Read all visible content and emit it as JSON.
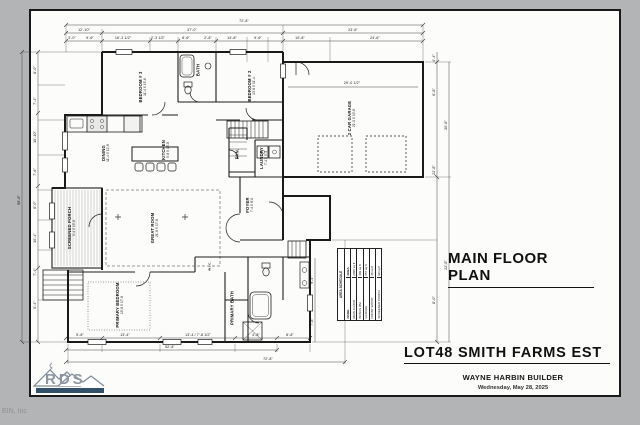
{
  "titleblock": {
    "plan_title": "MAIN FLOOR PLAN",
    "lot_title": "LOT48 SMITH FARMS EST",
    "builder": "WAYNE HARBIN BUILDER",
    "date": "Wednesday, May 28, 2025"
  },
  "logo": {
    "text": "RDS"
  },
  "footer": {
    "stamp": "EIN, Inc"
  },
  "colors": {
    "line": "#1a1a1a",
    "paper": "#fcfcfb",
    "page_background": "#b2b4b6",
    "logo_gray": "#8d97a3",
    "logo_bar_blue": "#33506b"
  },
  "rooms": {
    "bedroom3": {
      "name": "BEDROOM # 3",
      "size": "11'-4 X 13'-6"
    },
    "bath2": {
      "name": "BATH"
    },
    "bedroom2": {
      "name": "BEDROOM # 2",
      "size": "13'-6 X 11'-4"
    },
    "dining": {
      "name": "DINING",
      "size": "11'-4 X 12'-8"
    },
    "kitchen": {
      "name": "KITCHEN",
      "size": "9'-8 X 16'-8"
    },
    "pantry": {
      "name": "PAN."
    },
    "laundry": {
      "name": "LAUNDRY",
      "size": "7'-4 X 5'-4"
    },
    "foyer": {
      "name": "FOYER",
      "size": "7'-4 X 8'-0"
    },
    "great_room": {
      "name": "GREAT ROOM",
      "size": "21'-8 X 17'-8"
    },
    "screened_porch": {
      "name": "SCREENED PORCH",
      "size": "9'-4 X 15'-8"
    },
    "primary_bedroom": {
      "name": "PRIMARY BEDROOM",
      "size": "15'-8 X 17'-8"
    },
    "primary_bath": {
      "name": "PRIMARY BATH"
    },
    "wic": {
      "name": "W.I.C."
    },
    "garage": {
      "name": "2 CAR GARAGE",
      "size": "21'-0 X 19'-8"
    }
  },
  "schedule": {
    "title": "AREA SCHEDULE",
    "columns": [
      "NAME",
      "AREA"
    ],
    "rows": [
      [
        "MAIN FLOOR",
        "2095 sq ft"
      ],
      [
        "BONUS RM",
        "409 sq ft"
      ],
      [
        "GARAGE",
        "657 sq ft"
      ],
      [
        "FRONT ENTRY",
        "45 sq ft"
      ],
      [
        "SCREENED PORCH",
        "90 sq ft"
      ]
    ]
  },
  "dims": {
    "top_total": "72'-8\"",
    "top_mid": [
      "12'-10\"",
      "37'-0\"",
      "23'-6\""
    ],
    "top_detail": [
      "3'-0\"",
      "9'-6\"",
      "16'-3 1/2\"",
      "2'-3 1/2\"",
      "8'-6\"",
      "2'-8\"",
      "14'-8\"",
      "9'-6\"",
      "10'-8\"",
      "24'-6\""
    ],
    "bottom_detail": [
      "5'-8\"",
      "13'-4\"",
      "13'-4 / 7'-8 1/2\"",
      "4'-8\"",
      "8'-8\""
    ],
    "bottom_mid": "52'-8\"",
    "bottom_total": "72'-8\"",
    "left_total": "58'-8\"",
    "left_detail": [
      "8'-0\"",
      "7'-4\"",
      "10'-10\"",
      "7'-6\"",
      "8'-0\"",
      "10'-4\"",
      "7'-4\"",
      "5'-4\""
    ],
    "right_detail": [
      "4'-4\"",
      "6'-8\"",
      "22'-8\"",
      "8'-0\""
    ],
    "right_mid": [
      "30'-8\"",
      "22'-8\""
    ],
    "garage_width": "29'-0 1/2\"",
    "bath_heights": [
      "9'-4\"",
      "7'-8\""
    ]
  }
}
